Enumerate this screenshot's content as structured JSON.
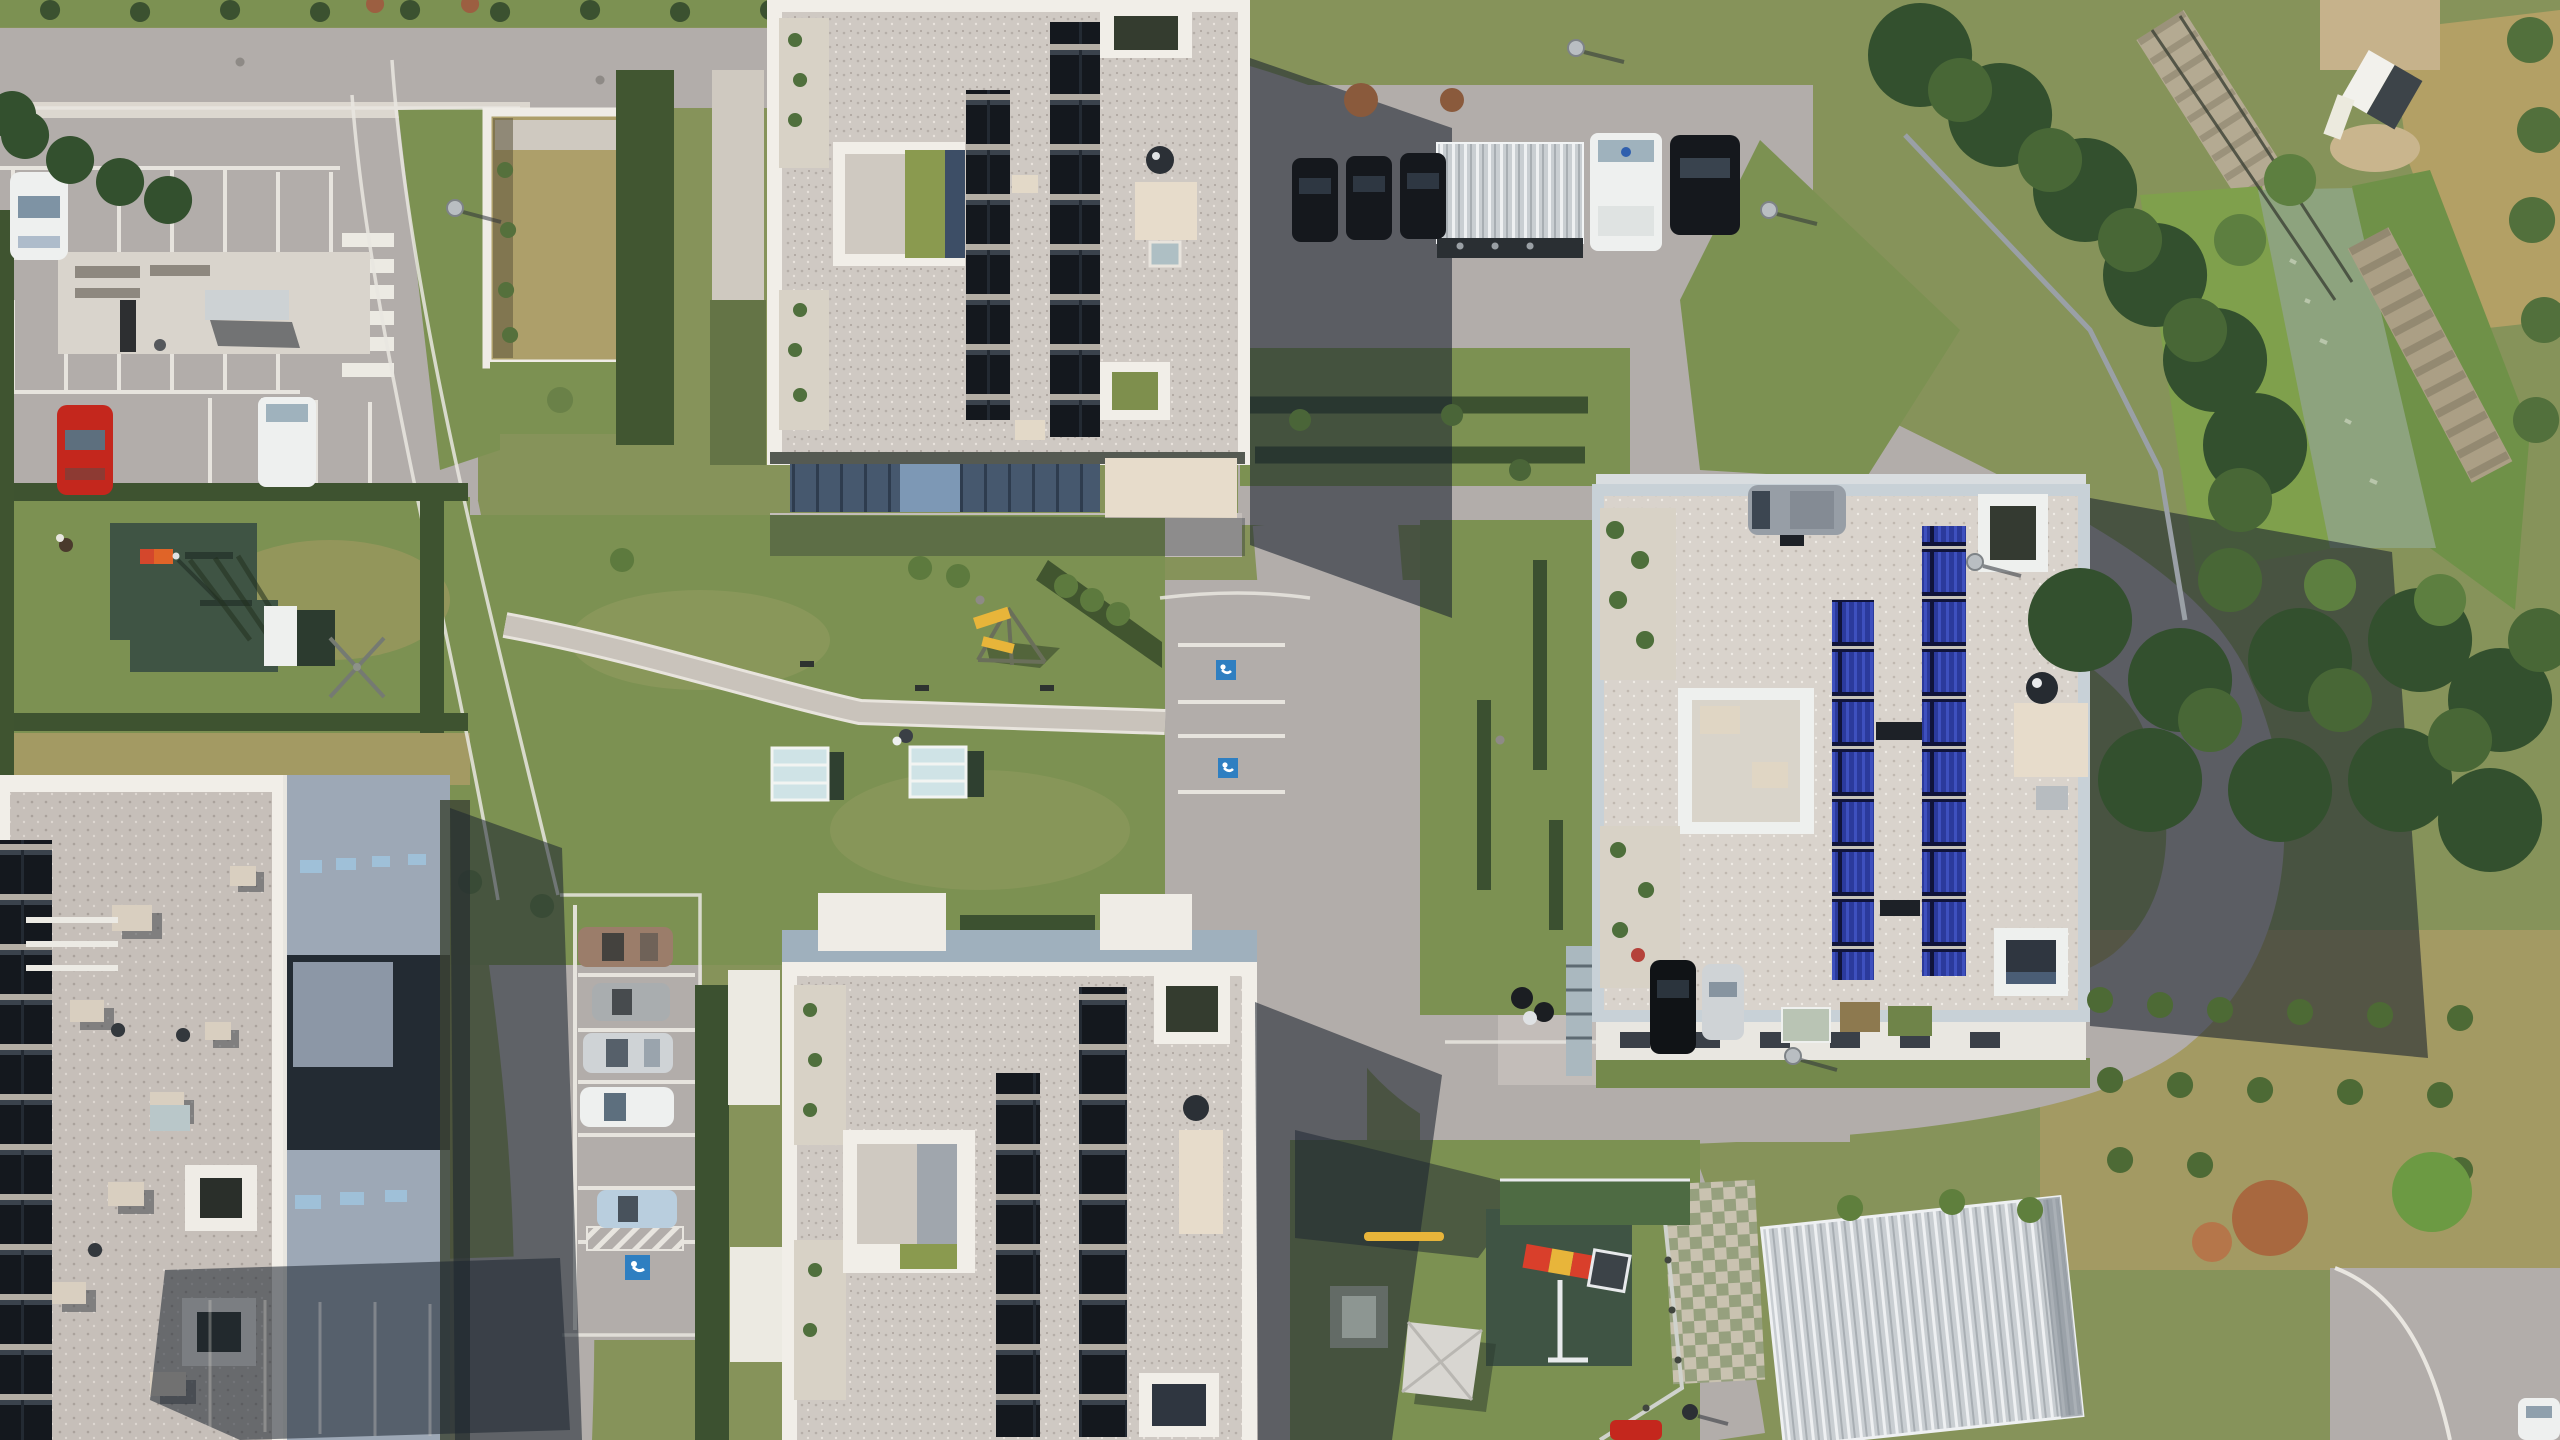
{
  "meta": {
    "scene": "aerial-drone-orthophoto",
    "subject": "residential apartment complex with flat gravel roofs, rooftop solar arrays, parking areas, playgrounds, access roads and a stream with stone embankments on the east side",
    "lighting": "sunny, hard shadows cast toward the east"
  },
  "colors": {
    "grass_base": "#86935a",
    "grass_bright": "#7fa04c",
    "grass_mid": "#7c9152",
    "grass_dry": "#a39a63",
    "grass_reed": "#6f9148",
    "field_dry": "#b3a065",
    "hedge": "#3d5230",
    "tree_dark": "#33502e",
    "tree_light": "#5d7f40",
    "asphalt": "#b2adaa",
    "asphalt_pale": "#c3bdb9",
    "concrete": "#d9d4cc",
    "sidewalk": "#dcd7cf",
    "curb": "#e9e6e0",
    "shadow": "#1c2430",
    "parapet": "#f1eee8",
    "parapet_rb": "#c8d1d7",
    "cream": "#e7dccb",
    "terrace": "#d8d2c6",
    "glass_blue": "#46586e",
    "glass_light": "#7d98b5",
    "window_sky": "#9fc0d8",
    "metal_roof": "#9da8b6",
    "glazing_dark": "#232b33",
    "water": "#8da37e",
    "stone": "#b4aa92",
    "rubber_mat": "#3f5444",
    "court_green": "#4e6b43",
    "marking_white": "#eceae3",
    "disabled_blue": "#2f7fc1",
    "car_red": "#c4271d",
    "car_white": "#eef0ef",
    "car_dark": "#15181d",
    "car_silver": "#cfd3d6",
    "car_gray": "#979ea6",
    "car_bronze": "#9b7d6a",
    "car_lightblue": "#b9cede",
    "slide_red": "#d93f2b",
    "slide_yellow": "#e8b53a",
    "flag_orange": "#e06428",
    "sail": "#d8d6d1",
    "sand": "#c9b58d",
    "planter_brown": "#8a5a3c"
  },
  "scene": {
    "buildings": [
      {
        "id": "top-center",
        "roof": "white gravel, white parapet",
        "solar": "two columns of dark thermal collectors",
        "features": [
          "west terraces with plants",
          "inner courtyard",
          "cream penthouse with satellite dish",
          "blue glass south facade"
        ]
      },
      {
        "id": "bottom-center",
        "roof": "white gravel, white parapet",
        "solar": "two columns of dark thermal collectors",
        "features": [
          "west terraces",
          "inner courtyard",
          "cream penthouse",
          "north entrance canopies"
        ]
      },
      {
        "id": "right",
        "roof": "light gravel, pale blue parapet",
        "solar": "two columns of bright blue vacuum-tube collectors",
        "features": [
          "west patios with plants",
          "cream equipment pad with satellite dish",
          "corner light-wells",
          "long shadow cast east"
        ]
      },
      {
        "id": "bottom-left",
        "roof": "gravel west part with solar row on edge, gray standing-seam east part with dark glazing and skylights",
        "features": [
          "two square skylight frames",
          "roof vents",
          "pergola beams"
        ]
      }
    ],
    "vehicles": [
      {
        "id": "white-car-top-left-bay"
      },
      {
        "id": "red-car-left-bay"
      },
      {
        "id": "white-van-left-bay"
      },
      {
        "id": "dark-car-plaza-1"
      },
      {
        "id": "dark-car-plaza-2"
      },
      {
        "id": "dark-car-plaza-3"
      },
      {
        "id": "white-van-by-shelter"
      },
      {
        "id": "dark-car-by-shelter"
      },
      {
        "id": "gray-minivan"
      },
      {
        "id": "bronze-car-bays"
      },
      {
        "id": "gray-car-bays"
      },
      {
        "id": "silver-car-bays"
      },
      {
        "id": "white-car-bays"
      },
      {
        "id": "lightblue-car-bays"
      },
      {
        "id": "black-car-south-of-right-building"
      },
      {
        "id": "silver-car-south-of-right-building"
      },
      {
        "id": "quad-bike"
      },
      {
        "id": "red-car-bottom-edge"
      },
      {
        "id": "white-car-bottom-right-corner"
      }
    ],
    "amenities": [
      {
        "id": "playground-west",
        "items": [
          "green rubber mat",
          "orange windsock flag",
          "climbing frame",
          "white shed",
          "rotary clothes dryer"
        ]
      },
      {
        "id": "playground-southeast",
        "items": [
          "green rubber mat",
          "red-yellow slide",
          "seesaw",
          "picnic table",
          "shade sail",
          "fence"
        ]
      },
      {
        "id": "central-lawn",
        "items": [
          "footpath",
          "two glass canopies",
          "rope climber with yellow slides",
          "pedestrian with bag",
          "bollard lights"
        ]
      },
      {
        "id": "bench-terrace-north-west",
        "items": [
          "concrete pad",
          "benches",
          "canopy bench"
        ]
      },
      {
        "id": "bike-shelter-north",
        "type": "corrugated metal carport"
      },
      {
        "id": "carport-southeast",
        "type": "large corrugated metal canopy"
      }
    ],
    "landscape": [
      {
        "id": "stream",
        "desc": "green water, stone riprap banks, footbridge-like stone weirs"
      },
      {
        "id": "dry-meadow-northeast"
      },
      {
        "id": "tree-belt-along-ring-road"
      },
      {
        "id": "garden-hut-northeast"
      },
      {
        "id": "sunken-dry-garden-northwest"
      },
      {
        "id": "autumn-shrub-southeast"
      },
      {
        "id": "grass-grid-pavers"
      }
    ],
    "road_markings": [
      {
        "id": "zebra-crossing-west-road"
      },
      {
        "id": "disabled-bay-junction-1"
      },
      {
        "id": "disabled-bay-junction-2"
      },
      {
        "id": "disabled-bay-west"
      },
      {
        "id": "no-parking-hatch"
      },
      {
        "id": "white-bay-lines"
      }
    ]
  }
}
